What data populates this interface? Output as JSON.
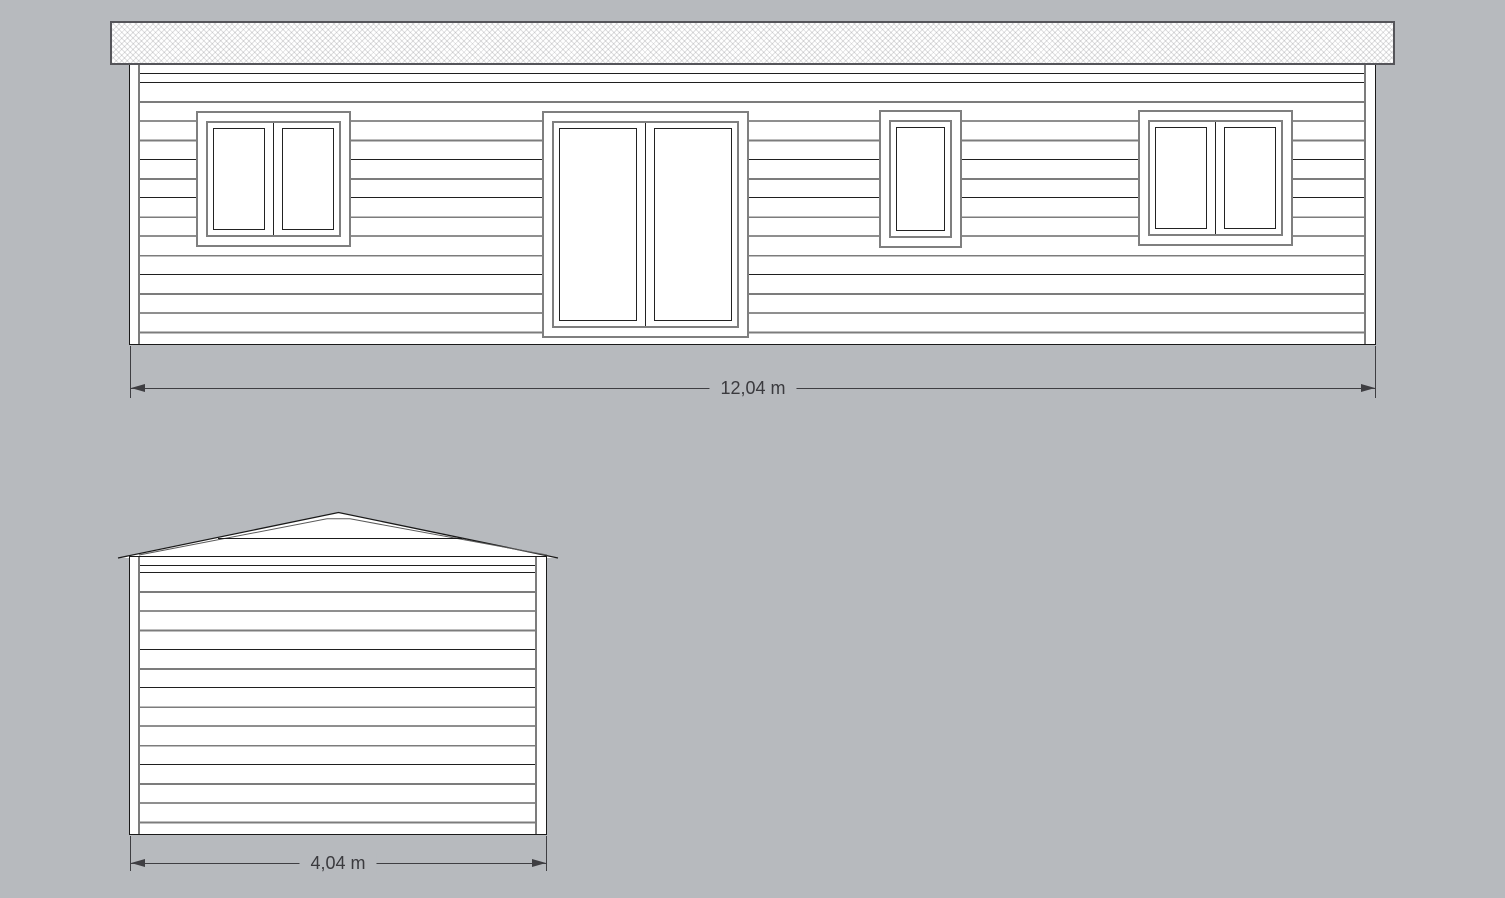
{
  "canvas": {
    "background": "#b7babe"
  },
  "front_elevation": {
    "dimension_label": "12,04 m",
    "openings": [
      {
        "type": "double-window"
      },
      {
        "type": "double-door"
      },
      {
        "type": "single-window"
      },
      {
        "type": "double-window"
      }
    ]
  },
  "gable_elevation": {
    "dimension_label": "4,04 m"
  },
  "colors": {
    "paper": "#ffffff",
    "outline": "#1a1a1a",
    "trim_gray": "#7c7c7c",
    "casing_gray": "#7f7f7f",
    "fascia_border": "#55555a",
    "dimension": "#3e3e42",
    "dimension_text": "#3a3a3e"
  }
}
